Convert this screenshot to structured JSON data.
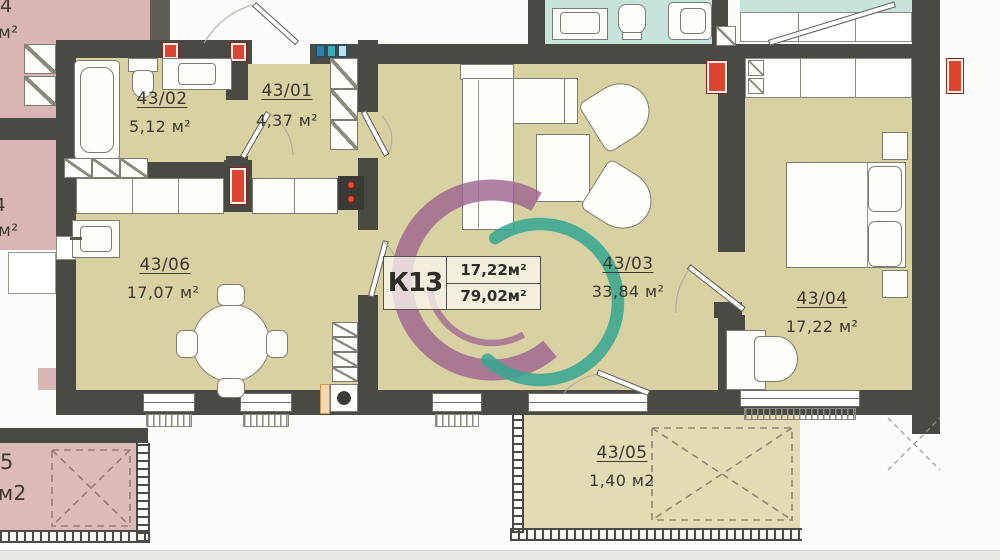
{
  "unit_card": {
    "code": "К13",
    "living_area": "17,22м²",
    "total_area": "79,02м²"
  },
  "rooms": {
    "r4301": {
      "number": "43/01",
      "area": "4,37 м²"
    },
    "r4302": {
      "number": "43/02",
      "area": "5,12 м²"
    },
    "r4303": {
      "number": "43/03",
      "area": "33,84 м²"
    },
    "r4304": {
      "number": "43/04",
      "area": "17,22 м²"
    },
    "r4305": {
      "number": "43/05",
      "area": "1,40 м2"
    },
    "r4306": {
      "number": "43/06",
      "area": "17,07 м²"
    }
  },
  "neighbors": {
    "top_left": {
      "number": "4",
      "unit": "м²"
    },
    "mid_left": {
      "number": "4",
      "unit": "м²"
    },
    "bottom_left": {
      "number": "5",
      "unit": "м2"
    }
  },
  "palette": {
    "room_fill": "#d8d1a2",
    "balcony_fill": "#e2dcb5",
    "neighbor_pink": "#d9b6b4",
    "neighbor_teal": "#c7e4dc",
    "wall": "#4a4a44",
    "logo_purple": "#9d6390",
    "logo_teal": "#35a692",
    "marker_red": "#df4430"
  }
}
